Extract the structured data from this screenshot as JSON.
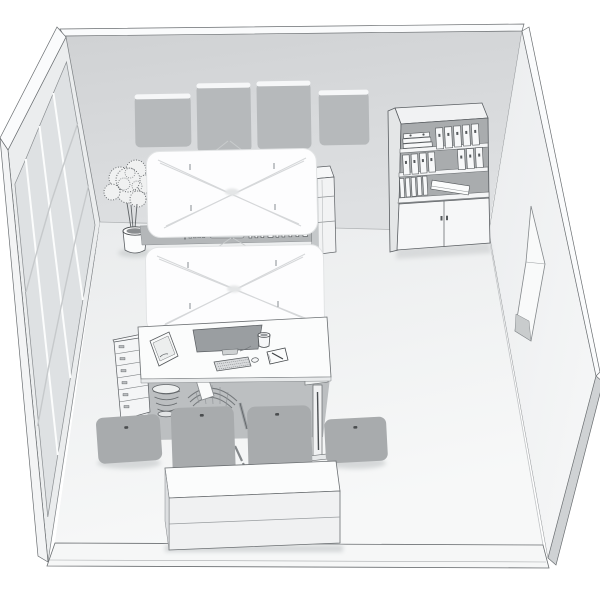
{
  "scene": {
    "kind": "isometric-office-room-render",
    "style": "grayscale architectural visualization, no text",
    "objects": [
      "left glazed wall with four window panes",
      "back wall with four acoustic wall panels",
      "right wall with door recess",
      "potted plant",
      "two white wire-base meeting tables",
      "storage rail with small binders between tables",
      "narrow side shelf",
      "bookshelf with ring binders and two-door cabinet",
      "desk with monitor, keyboard, mug, notepad, paper tray",
      "drawer pedestal",
      "wire wastebasket",
      "office task chair",
      "four gray seat panels",
      "white sideboard"
    ]
  },
  "palette": {
    "background": "#ffffff",
    "back_wall": "#d3d5d7",
    "wall_edge": "#fafbfc",
    "left_wall_face": "#ebedee",
    "window_glass": "#dee1e3",
    "right_wall_face": "#f4f5f6",
    "floor": "#f0f1f2",
    "floor_front": "#f8f9f9",
    "acoustic_panel": "#b6b9bb",
    "seat_panel": "#a8abad",
    "seat_panel_dot": "#4a4d4f",
    "furniture_white": "#fbfcfc",
    "shelf_interior": "#a9acae",
    "rail_gray": "#b4b7b9",
    "monitor_gray": "#9a9ea1",
    "under_desk_shadow": "#bcbfc1",
    "soft_shadow": "#cfd2d4",
    "outline_dark": "#5a5e62",
    "outline_light": "#9ca0a3"
  }
}
